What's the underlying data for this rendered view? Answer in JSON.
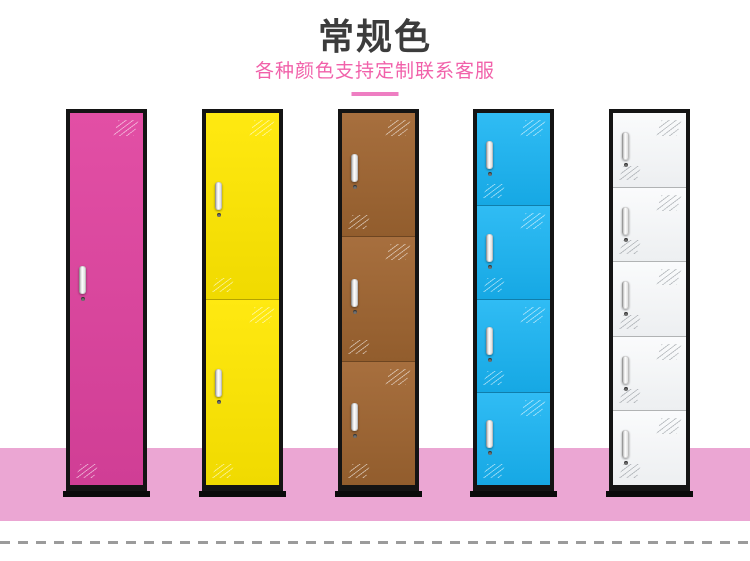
{
  "page": {
    "width": 750,
    "height": 561,
    "background": "#ffffff"
  },
  "header": {
    "title": "常规色",
    "title_color": "#3c3c3c",
    "subtitle": "各种颜色支持定制联系客服",
    "subtitle_color": "#f161aa",
    "underline_color": "#ee7ec2"
  },
  "cabinets": [
    {
      "id": "pink",
      "color_name": "pink-magenta",
      "doors": 1,
      "door_color_top": "#e24fa5",
      "door_color_bottom": "#d03e95",
      "shine": "light"
    },
    {
      "id": "yellow",
      "color_name": "yellow",
      "doors": 2,
      "door_color_top": "#ffe911",
      "door_color_bottom": "#f0da00",
      "shine": "light"
    },
    {
      "id": "brown",
      "color_name": "brown",
      "doors": 3,
      "door_color_top": "#a76f3e",
      "door_color_bottom": "#925d2d",
      "shine": "light"
    },
    {
      "id": "blue",
      "color_name": "sky-blue",
      "doors": 4,
      "door_color_top": "#30bcf4",
      "door_color_bottom": "#16a8e4",
      "shine": "light"
    },
    {
      "id": "white",
      "color_name": "white",
      "doors": 5,
      "door_color_top": "#fafbfc",
      "door_color_bottom": "#edeff1",
      "shine": "dark"
    }
  ],
  "frame_color": "#141414",
  "floor": {
    "color": "#eba6d3"
  },
  "bottom_divider": {
    "style": "dashed",
    "color": "#9b9b9b"
  }
}
